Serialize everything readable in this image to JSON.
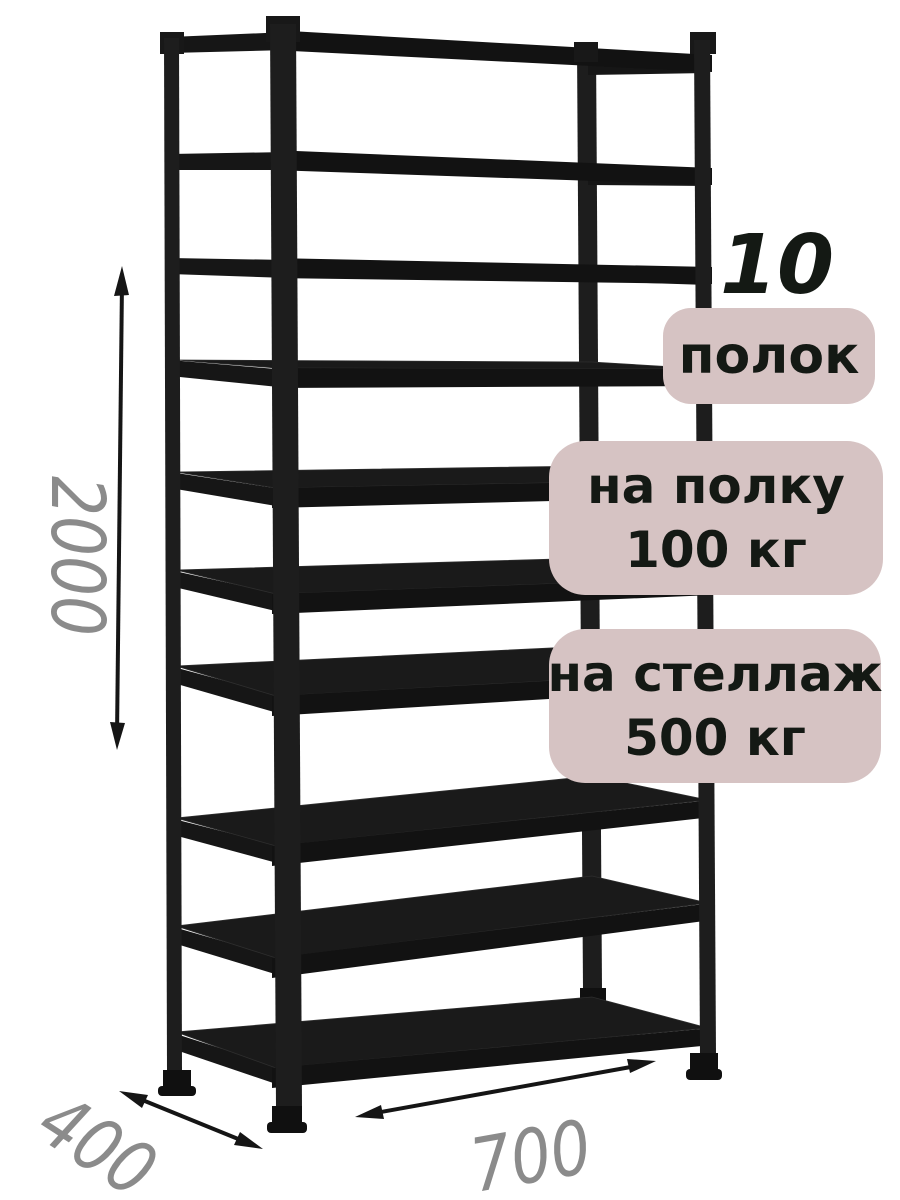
{
  "page": {
    "background": "#ffffff"
  },
  "rack": {
    "description": "black metal shelving rack",
    "shelf_count": 10,
    "color": "#1b1b1b"
  },
  "dimensions": {
    "height": "2000",
    "depth": "400",
    "width": "700",
    "text_color": "#8b8b8b",
    "arrow_color": "#151515"
  },
  "badges": {
    "bg_color": "#d6c3c3",
    "text_color": "#141914",
    "count_number": "10",
    "count_label": "полок",
    "shelf_load": {
      "line1": "на полку",
      "line2": "100 кг"
    },
    "rack_load": {
      "line1": "на стеллаж",
      "line2": "500 кг"
    }
  }
}
